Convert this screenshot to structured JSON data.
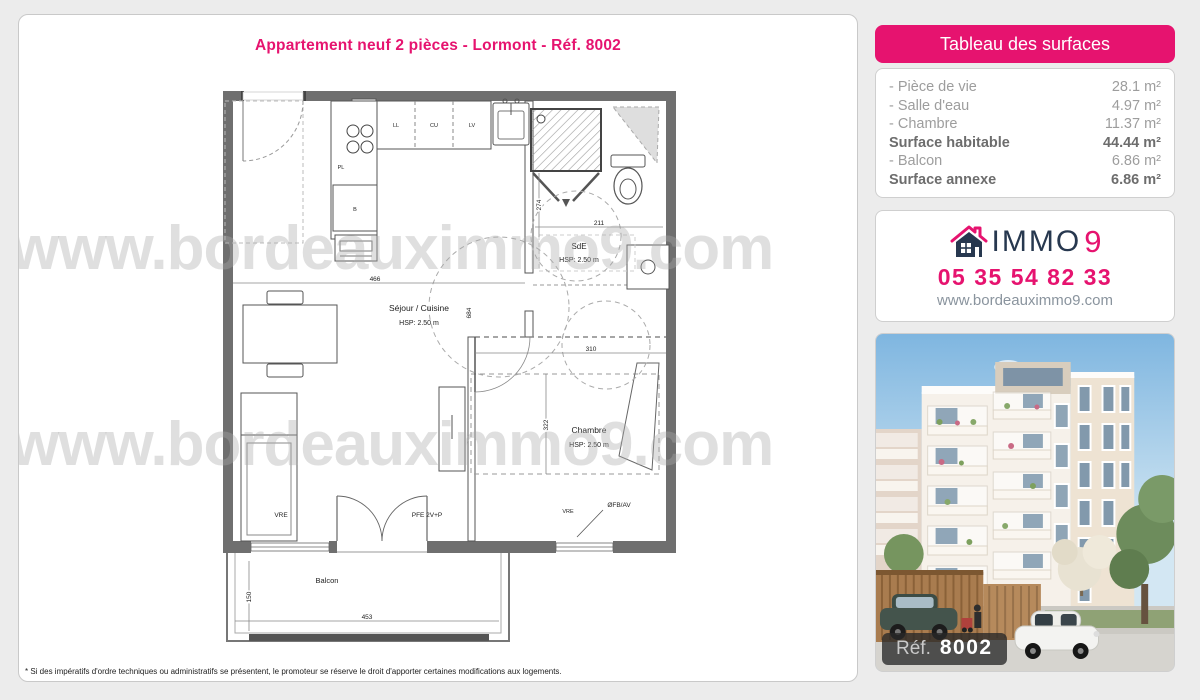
{
  "page": {
    "title": "Appartement neuf 2 pièces - Lormont - Réf. 8002",
    "watermark": "www.bordeauximmo9.com",
    "disclaimer": "* Si des impératifs d'ordre techniques ou administratifs se présentent, le promoteur se réserve le droit d'apporter certaines modifications aux logements."
  },
  "surfaces_panel": {
    "header": "Tableau des surfaces",
    "rows": [
      {
        "label": "- Pièce de vie",
        "value": "28.1 m²"
      },
      {
        "label": "- Salle d'eau",
        "value": "4.97 m²"
      },
      {
        "label": "- Chambre",
        "value": "11.37 m²"
      },
      {
        "label": "Surface habitable",
        "value": "44.44 m²"
      },
      {
        "label": "- Balcon",
        "value": "6.86 m²"
      },
      {
        "label": "Surface annexe",
        "value": "6.86 m²"
      }
    ]
  },
  "agency": {
    "brand_immo": "IMMO",
    "brand_9": "9",
    "phone": "05 35 54 82 33",
    "website": "www.bordeauximmo9.com"
  },
  "photo": {
    "ref_label": "Réf.",
    "ref_number": "8002"
  },
  "floorplan": {
    "rooms": {
      "sejour": {
        "name": "Séjour / Cuisine",
        "hsp": "HSP: 2.50 m"
      },
      "sde": {
        "name": "SdE",
        "hsp": "HSP: 2.50 m"
      },
      "chambre": {
        "name": "Chambre",
        "hsp": "HSP: 2.50 m"
      },
      "balcon": {
        "name": "Balcon"
      }
    },
    "dims": {
      "living_w": "466",
      "living_h": "684",
      "sde_w": "211",
      "sde_h": "274",
      "chambre_w": "310",
      "chambre_h": "322",
      "balcon_w": "453",
      "balcon_h": "150"
    },
    "tags": {
      "vre_left": "VRE",
      "pfe": "PFE 2V+P",
      "vre_right": "VRE",
      "ofb": "ØFB/AV",
      "ll": "LL",
      "cu": "CU",
      "lv": "LV",
      "pl": "PL",
      "b": "B"
    }
  },
  "colors": {
    "accent_pink": "#e6136f",
    "brand_navy": "#27384f",
    "wall_gray": "#6f6f6f"
  }
}
